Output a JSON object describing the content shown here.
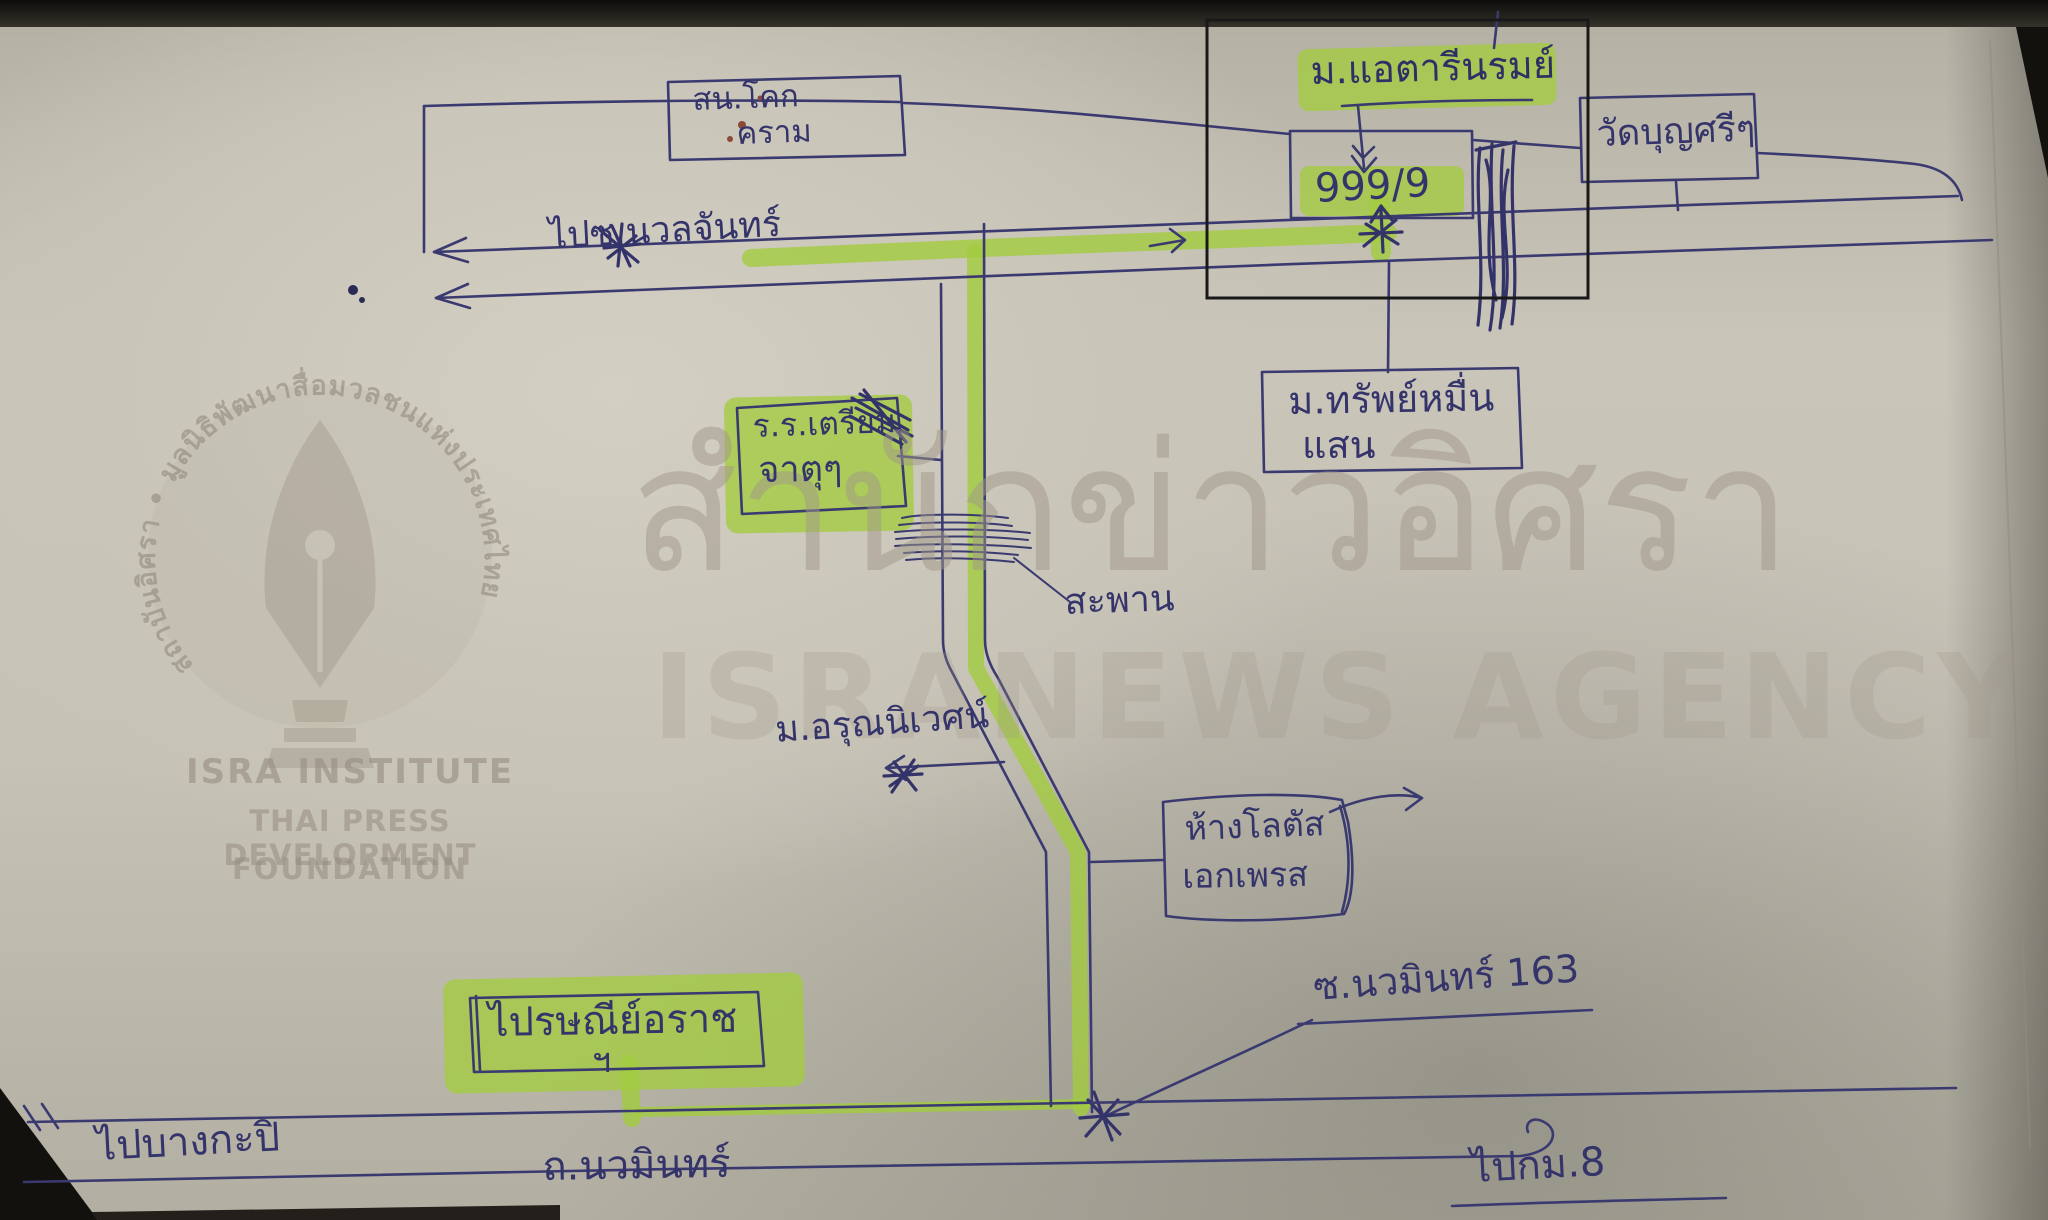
{
  "watermarks": {
    "ring_text": "สถาบันอิศรา • มูลนิธิพัฒนาสื่อมวลชนแห่งประเทศไทย",
    "institute_line1": "ISRA INSTITUTE",
    "institute_line2": "THAI PRESS DEVELOPMENT",
    "institute_line3": "FOUNDATION",
    "agency_thai": "สำนักข่าวอิศรา",
    "agency_english": "ISRANEWS AGENCY"
  },
  "map": {
    "police_station": {
      "line1": "สน.โคก",
      "line2": "คราม"
    },
    "village_green_top": {
      "label": "ม.แอตารีนรมย์"
    },
    "house_number": {
      "label": "999/9"
    },
    "temple": {
      "label": "วัดบุญศรีๆ"
    },
    "nuanchan_road": {
      "label": "ไปซ.นวลจันทร์"
    },
    "school_green": {
      "line1": "ร.ร.เตรียม",
      "line2": "จาตุๆ"
    },
    "sap_muen_saen": {
      "line1": "ม.ทรัพย์หมื่น",
      "line2": "แสน"
    },
    "bridge": {
      "label": "สะพาน"
    },
    "arun_nivet": {
      "label": "ม.อรุณนิเวศน์"
    },
    "lotus": {
      "line1": "ห้างโลตัส",
      "line2": "เอกเพรส"
    },
    "soi_nawamin_163": {
      "label": "ซ.นวมินทร์ 163"
    },
    "post_office_green": {
      "label": "ไปรษณีย์อราช",
      "sub": "ฯ"
    },
    "to_bangkapi": {
      "label": "ไปบางกะปิ"
    },
    "nawamin_road": {
      "label": "ถ.นวมินทร์"
    },
    "to_km8": {
      "label": "ไปกม.8"
    }
  },
  "colors": {
    "pen_blue": "#3a3a70",
    "highlighter_green": "#a3cc3f",
    "paper": "#c6c2b6",
    "emphasis_frame": "#191919",
    "watermark_gray": "#9a9183"
  }
}
